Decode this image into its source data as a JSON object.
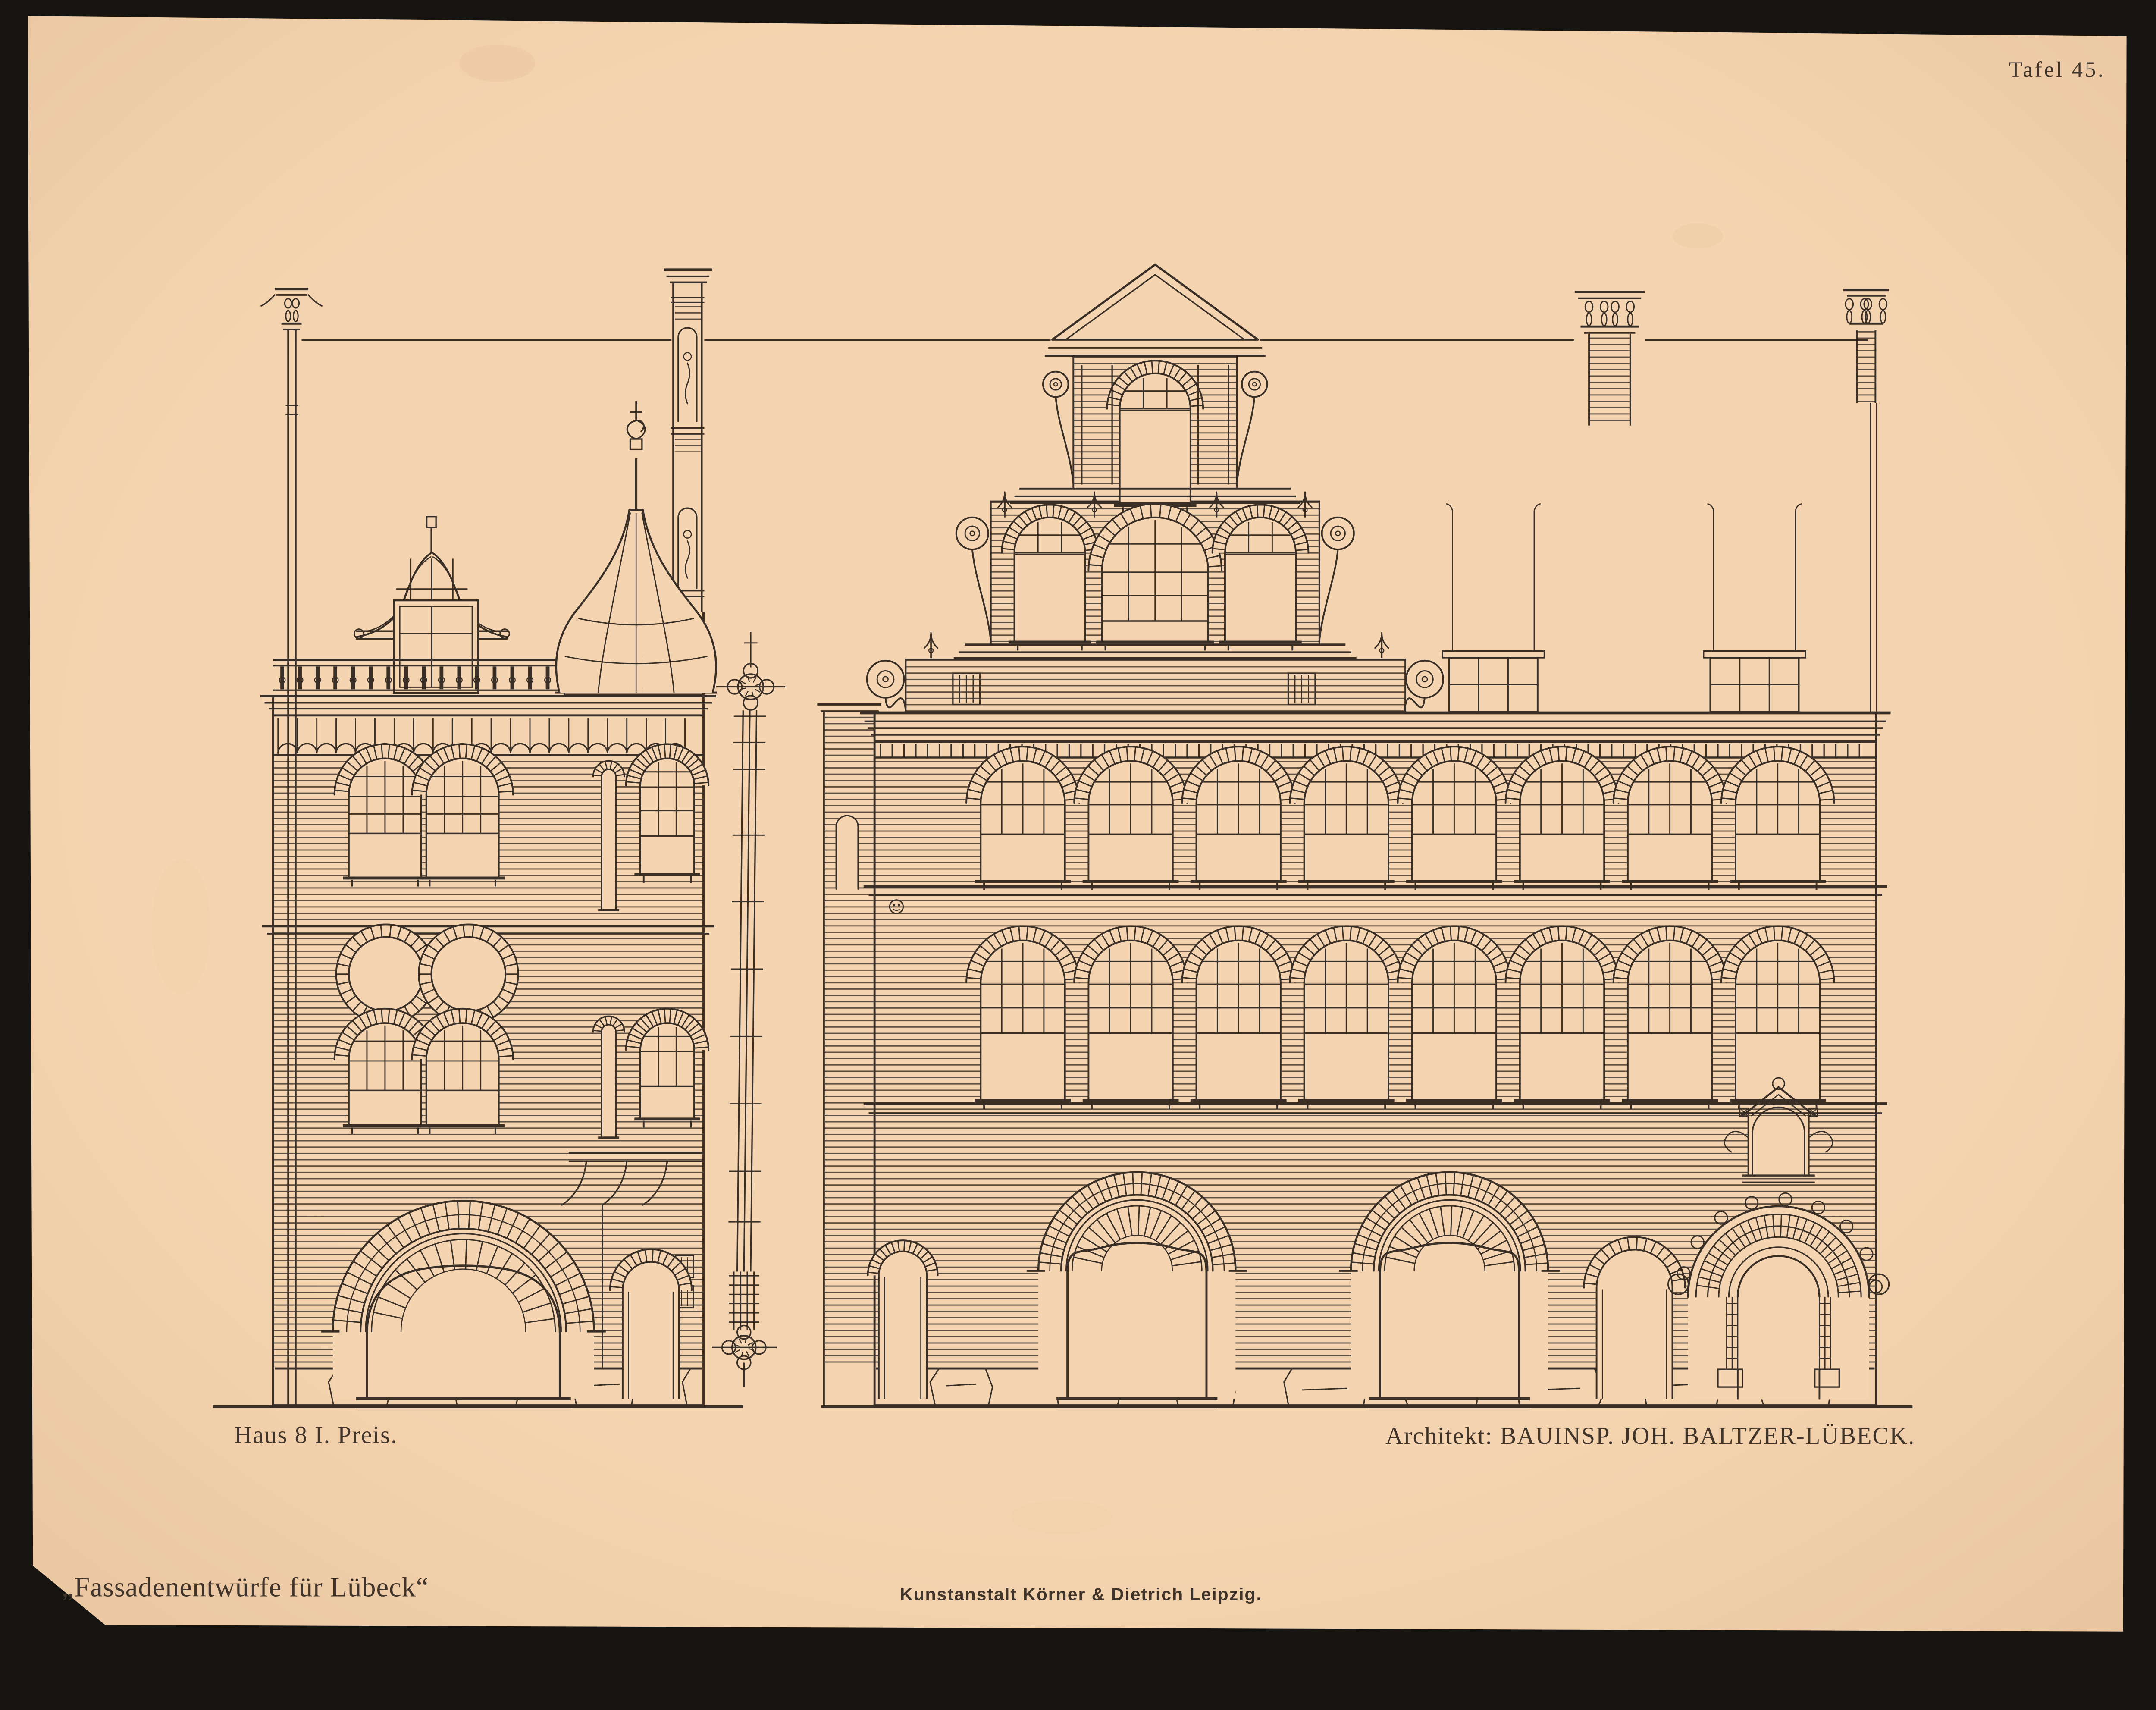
{
  "plate": {
    "number_label": "Tafel 45.",
    "left_caption": "Haus 8  I. Preis.",
    "right_caption": "Architekt: BAUINSP. JOH. BALTZER-LÜBECK.",
    "series_title": "„Fassadenentwürfe für Lübeck“",
    "imprint": "Kunstanstalt Körner & Dietrich Leipzig.",
    "colors": {
      "paper": "#f5d5b1",
      "ink": "#3a2f26",
      "scan_background": "#161410"
    }
  }
}
